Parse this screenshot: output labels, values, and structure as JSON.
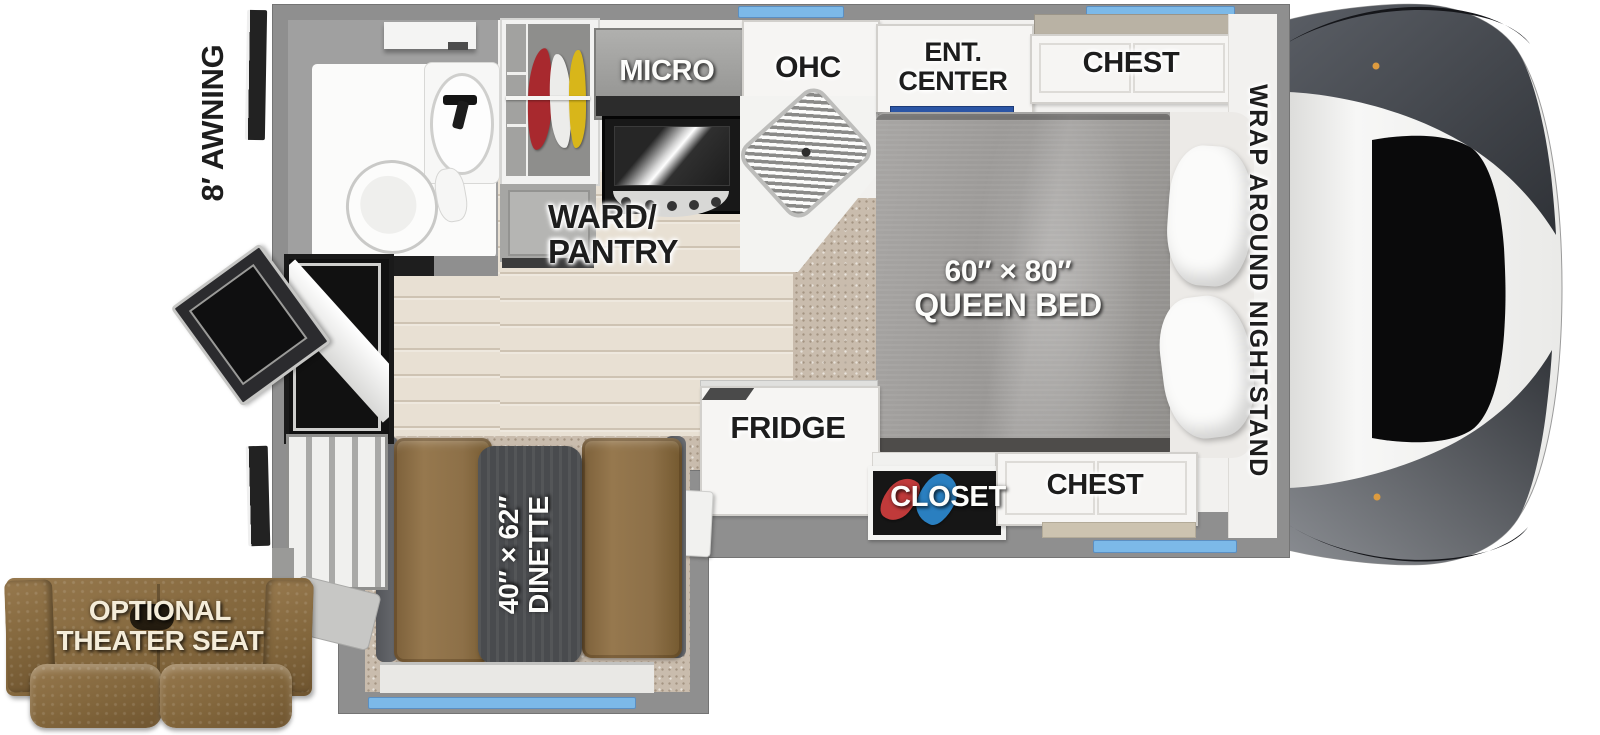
{
  "title": "Truck camper floor plan",
  "labels": {
    "awning": "8′ AWNING",
    "micro": "MICRO",
    "ohc": "OHC",
    "ent_line1": "ENT.",
    "ent_line2": "CENTER",
    "chest_top": "CHEST",
    "nightstand": "WRAP AROUND NIGHTSTAND",
    "ward_line1": "WARD/",
    "ward_line2": "PANTRY",
    "bed_line1": "60″ × 80″",
    "bed_line2": "QUEEN BED",
    "fridge": "FRIDGE",
    "closet": "CLOSET",
    "chest_bottom": "CHEST",
    "dinette_line1": "40″ × 62″",
    "dinette_line2": "DINETTE",
    "seat_line1": "OPTIONAL",
    "seat_line2": "THEATER SEAT"
  },
  "colors": {
    "wall": "#8f8f8f",
    "win": "#7cb9e8",
    "wood": "#e8e0d3",
    "carpet": "#c9bcad",
    "bed": "#a3a19f",
    "bench": "#8d7048",
    "tabletop": "#494b4e",
    "sofa": "#8d7048",
    "accent": "#2b55a5"
  }
}
